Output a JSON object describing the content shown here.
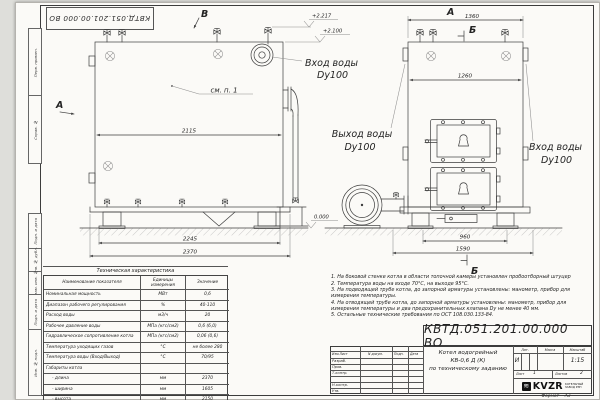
{
  "stamp_top": "КВТД.051.201.00.000 ВО",
  "frame": {
    "columns": [
      "Перв. примен.",
      "Справ. №",
      "Подп. и дата",
      "Инв. № дубл.",
      "Взам. инв. №",
      "Подп. и дата",
      "Инв. № подл."
    ],
    "format_label": "Формат",
    "format_value": "А3"
  },
  "views": {
    "b_arrow": "В",
    "a_arrow": "А",
    "a_view": "А",
    "b_section_top": "Б",
    "b_section_bottom": "Б",
    "see_item": "см. п. 1",
    "elev_top": "+2.217",
    "elev_mid": "+2.100",
    "elev_zero": "0.000",
    "inlet_line1": "Вход воды",
    "inlet_line2": "Dy100",
    "outlet_line1": "Выход воды",
    "outlet_line2": "Dy100",
    "inlet2_line1": "Вход воды",
    "inlet2_line2": "Dy100"
  },
  "dims": {
    "d2115": "2115",
    "d2245": "2245",
    "d2370": "2370",
    "d1360": "1360",
    "d1260": "1260",
    "d960": "960",
    "d1590": "1590"
  },
  "tech_table": {
    "title": "Техническая характеристика",
    "col_headers": [
      "Наименование показателя",
      "Единицы измерения",
      "Значение"
    ],
    "rows": [
      {
        "name": "Номинальная мощность",
        "unit": "МВт",
        "value": "0,6"
      },
      {
        "name": "Диапазон рабочего регулирования",
        "unit": "%",
        "value": "40-110"
      },
      {
        "name": "Расход воды",
        "unit": "м3/ч",
        "value": "20"
      },
      {
        "name": "Рабочее давление воды",
        "unit": "МПа (кгс/см2)",
        "value": "0,6 (6,0)"
      },
      {
        "name": "Гидравлическое сопротивление котла",
        "unit": "МПа (кгс/см2)",
        "value": "0,06 (0,6)"
      },
      {
        "name": "Температура уходящих газов",
        "unit": "°С",
        "value": "не более 280"
      },
      {
        "name": "Температура воды (Вход/Выход)",
        "unit": "°С",
        "value": "70/95"
      },
      {
        "name": "Габариты котла",
        "unit": "",
        "value": ""
      },
      {
        "name": "- длина",
        "unit": "мм",
        "value": "2370"
      },
      {
        "name": "- ширина",
        "unit": "мм",
        "value": "1605"
      },
      {
        "name": "- высота",
        "unit": "мм",
        "value": "2150"
      }
    ]
  },
  "notes": [
    "1. На боковой стенке котла в области топочной камеры установлен пробоотборный штуцер",
    "2. Температура воды на входе 70°С, на выходе 95°С.",
    "3. На подводящей трубе котла, до запорной арматуры установлены: манометр, прибор для измерения температуры.",
    "4. На отводящей трубе котла, до запорной арматуры установлены: манометр, прибор для измерения температуры и два предохранительных клапана Dу не менее 40 мм.",
    "5. Остальные технические требования по ОСТ 108.030.133-84."
  ],
  "title_block": {
    "doc_number": "КВТД.051.201.00.000 ВО",
    "rev_col1": "Изм.Лист",
    "rev_col2": "N докум.",
    "rev_col3": "Подп.",
    "rev_col4": "Дата",
    "row1": "Разраб.",
    "row2": "Пров.",
    "row3": "Т.контр.",
    "row4": "Н.контр.",
    "row5": "Утв.",
    "title_line1": "Котел водогрейный",
    "title_line2": "КВ-0,6 Д (К)",
    "title_line3": "по техническому заданию",
    "lit_label": "Лит.",
    "mass_label": "Масса",
    "scale_label": "Масштаб",
    "lit_value": "И",
    "scale_value": "1:15",
    "sheet_label": "Лист",
    "sheet_value": "1",
    "sheets_label": "Листов",
    "sheets_value": "2",
    "brand_mark": "≋",
    "brand": "KVZR",
    "brand_sub1": "КОТЕЛЬНЫЙ",
    "brand_sub2": "ЗАВОД РЭП"
  }
}
